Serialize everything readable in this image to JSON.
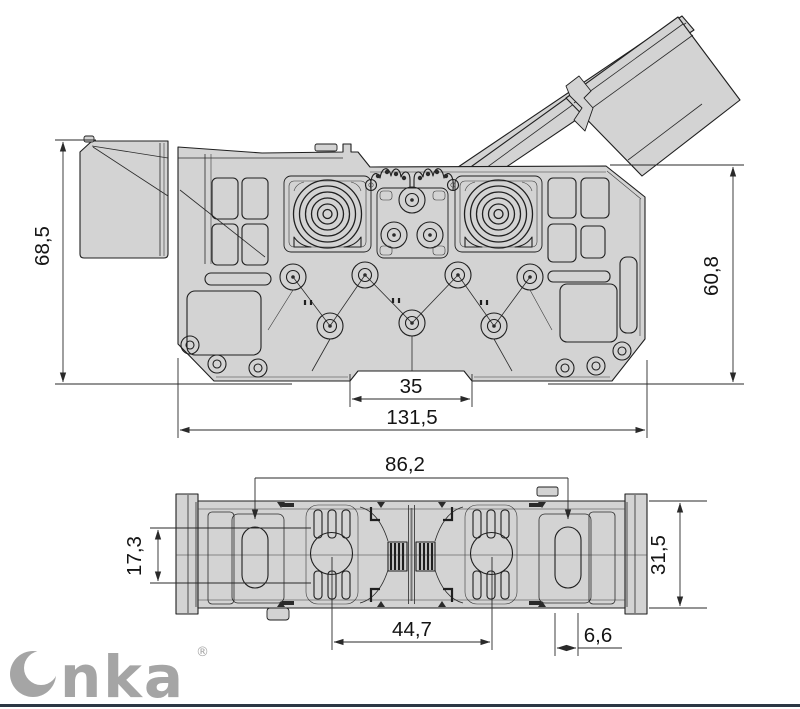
{
  "side_view": {
    "dim_left_height": "68,5",
    "dim_right_height": "60,8",
    "dim_rail_slot_width": "35",
    "dim_overall_width": "131,5"
  },
  "plan_view": {
    "dim_mounting_span": "86,2",
    "dim_end_slot_length": "17,3",
    "dim_body_width": "31,5",
    "dim_center_span": "44,7",
    "dim_end_slot_width": "6,6"
  },
  "logo": {
    "brand": "Onka",
    "registered_mark": "®"
  },
  "colors": {
    "body_fill": "#d3d3d3",
    "outline": "#1f1f1f",
    "dimension": "#2a2a2a",
    "logo_gray": "#a5a5a5",
    "footer_rule": "#2c3744",
    "background": "#ffffff"
  }
}
